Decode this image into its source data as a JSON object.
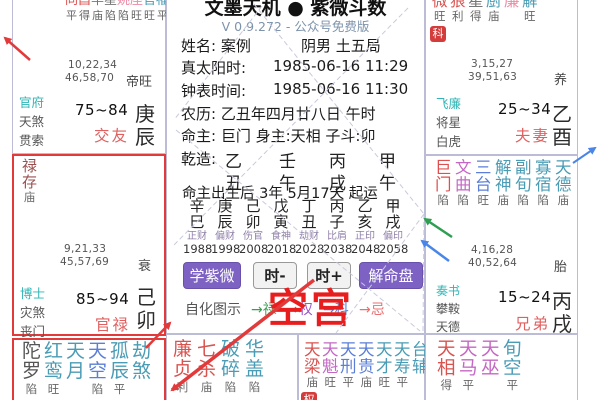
{
  "app": {
    "title": "文墨天机 ● 紫微斗数",
    "version": "V 0.9.272 - 公众号免费版"
  },
  "colors": {
    "red": "#e23a3a",
    "green": "#2e9e50",
    "blue": "#4a86e8"
  },
  "info": {
    "name_label": "姓名: 案例",
    "gender_bureau": "阴男 土五局",
    "solar_label": "真太阳时:",
    "solar_value": "1985-06-16  11:29",
    "clock_label": "钟表时间:",
    "clock_value": "1985-06-16  11:30",
    "lunar": "农历: 乙丑年四月廿八日 午时",
    "masters": "命主: 巨门 身主:天相 子斗:卯",
    "qianzao_label": "乾造:",
    "stems": [
      "乙",
      "壬",
      "丙",
      "甲"
    ],
    "branches": [
      "丑",
      "午",
      "戌",
      "午"
    ],
    "qiyun": "命主出生后 3年 5月17天 起运"
  },
  "dayun": {
    "columns": [
      {
        "stem": "辛",
        "branch": "巳",
        "god": "正财",
        "year": "1988"
      },
      {
        "stem": "庚",
        "branch": "辰",
        "god": "偏财",
        "year": "1998"
      },
      {
        "stem": "己",
        "branch": "卯",
        "god": "伤官",
        "year": "2008"
      },
      {
        "stem": "戊",
        "branch": "寅",
        "god": "食神",
        "year": "2018"
      },
      {
        "stem": "丁",
        "branch": "丑",
        "god": "劫财",
        "year": "2028"
      },
      {
        "stem": "丙",
        "branch": "子",
        "god": "比肩",
        "year": "2038"
      },
      {
        "stem": "乙",
        "branch": "亥",
        "god": "正印",
        "year": "2048"
      },
      {
        "stem": "甲",
        "branch": "戌",
        "god": "偏印",
        "year": "2058"
      }
    ]
  },
  "toolbar": {
    "learn": "学紫微",
    "minus": "时-",
    "plus": "时+",
    "explain": "解命盘"
  },
  "zihua": {
    "label": "自化图示",
    "lu": "→禄",
    "quan": "→权",
    "ke": "→科",
    "ji": "→忌",
    "lu_color": "#3aa050",
    "quan_color": "#9a55c8",
    "ke_color": "#5080d0",
    "ji_color": "#e87070"
  },
  "annotation": {
    "empty": "空宫",
    "color": "#e81e1e"
  },
  "palaces": {
    "jiaoyou": {
      "stars": [
        {
          "c": "同",
          "b": "平",
          "color": "#d9534f"
        },
        {
          "c": "昌",
          "b": "得",
          "color": "#d9534f"
        },
        {
          "c": "羊",
          "b": "庙",
          "color": "#777777"
        },
        {
          "c": "星",
          "b": "陷",
          "color": "#777777"
        },
        {
          "c": "姚",
          "b": "陷",
          "color": "#ed8aa5"
        },
        {
          "c": "座",
          "b": "旺",
          "color": "#ed8aa5"
        },
        {
          "c": "官",
          "b": "旺",
          "color": "#4a9cb5"
        },
        {
          "c": "福",
          "b": "平",
          "color": "#4a9cb5"
        }
      ],
      "nums1": "10,22,34",
      "nums2": "46,58,70",
      "stage": "帝旺",
      "gods": [
        {
          "t": "官府",
          "color": "#2fb5b5"
        },
        {
          "t": "天煞",
          "color": "#555555"
        },
        {
          "t": "贯索",
          "color": "#555555"
        }
      ],
      "age": "75~84",
      "name": "交友",
      "gz": "庚辰"
    },
    "guanlu": {
      "stars": [
        {
          "c": "禄存",
          "b": "庙",
          "color": "#9c4f4f"
        }
      ],
      "nums1": "9,21,33",
      "nums2": "45,57,69",
      "stage": "衰",
      "gods": [
        {
          "t": "博士",
          "color": "#2fb5b5"
        },
        {
          "t": "灾煞",
          "color": "#555555"
        },
        {
          "t": "丧门",
          "color": "#555555"
        }
      ],
      "age": "85~94",
      "name": "官禄",
      "gz": "己卯"
    },
    "fuqi": {
      "stars": [
        {
          "c": "微",
          "b": "旺",
          "color": "#d9534f"
        },
        {
          "c": "狼",
          "b": "利",
          "color": "#d9534f"
        },
        {
          "c": "星",
          "b": "得",
          "color": "#777777"
        },
        {
          "c": "厨",
          "b": "庙",
          "color": "#4a9cb5"
        },
        {
          "c": "廉",
          "b": "",
          "color": "#ed8aa5"
        },
        {
          "c": "解",
          "b": "旺",
          "color": "#4a9cb5"
        }
      ],
      "badge": "科",
      "nums1": "3,15,27",
      "nums2": "39,51,63",
      "stage": "养",
      "gods": [
        {
          "t": "飞廉",
          "color": "#2fb5b5"
        },
        {
          "t": "将星",
          "color": "#555555"
        },
        {
          "t": "白虎",
          "color": "#555555"
        }
      ],
      "age": "25~34",
      "name": "夫妻",
      "gz": "乙酉"
    },
    "xiongdi": {
      "stars": [
        {
          "c": "巨门",
          "b": "陷",
          "color": "#e04f4f"
        },
        {
          "c": "文曲",
          "b": "陷",
          "color": "#c568c5"
        },
        {
          "c": "三台",
          "b": "旺",
          "color": "#5b7fd6"
        },
        {
          "c": "解神",
          "b": "庙",
          "color": "#4a9cb5"
        },
        {
          "c": "副旬",
          "b": "陷",
          "color": "#4a9cb5"
        },
        {
          "c": "寡宿",
          "b": "陷",
          "color": "#4a9cb5"
        },
        {
          "c": "天德",
          "b": "庙",
          "color": "#4a9cb5"
        }
      ],
      "nums1": "4,16,28",
      "nums2": "40,52,64",
      "stage": "胎",
      "gods": [
        {
          "t": "奏书",
          "color": "#2fb5b5"
        },
        {
          "t": "攀鞍",
          "color": "#555555"
        },
        {
          "t": "天德",
          "color": "#555555"
        }
      ],
      "age": "15~24",
      "name": "兄弟",
      "gz": "丙戌"
    },
    "b1": {
      "stars": [
        {
          "c": "陀罗",
          "b": "陷",
          "color": "#555555"
        },
        {
          "c": "红鸾",
          "b": "旺",
          "color": "#4a9cb5"
        },
        {
          "c": "天月",
          "b": "",
          "color": "#4a9cb5"
        },
        {
          "c": "天空",
          "b": "陷",
          "color": "#5b7fd6"
        },
        {
          "c": "孤辰",
          "b": "平",
          "color": "#4a9cb5"
        },
        {
          "c": "劫煞",
          "b": "",
          "color": "#4a9cb5"
        }
      ]
    },
    "b2": {
      "stars": [
        {
          "c": "廉贞",
          "b": "利",
          "color": "#d9534f"
        },
        {
          "c": "七杀",
          "b": "庙",
          "color": "#d9534f"
        },
        {
          "c": "破碎",
          "b": "陷",
          "color": "#4a9cb5"
        },
        {
          "c": "华盖",
          "b": "陷",
          "color": "#4a9cb5"
        }
      ]
    },
    "b3": {
      "stars": [
        {
          "c": "天梁",
          "b": "庙",
          "color": "#d9534f"
        },
        {
          "c": "天魁",
          "b": "旺",
          "color": "#c568c5"
        },
        {
          "c": "天刑",
          "b": "平",
          "color": "#5b7fd6"
        },
        {
          "c": "天贵",
          "b": "庙",
          "color": "#5b7fd6"
        },
        {
          "c": "天才",
          "b": "旺",
          "color": "#4a9cb5"
        },
        {
          "c": "天寿",
          "b": "平",
          "color": "#4a9cb5"
        },
        {
          "c": "台辅",
          "b": "",
          "color": "#4a9cb5"
        }
      ],
      "badge": "权"
    },
    "b4": {
      "stars": [
        {
          "c": "天相",
          "b": "得",
          "color": "#d9534f"
        },
        {
          "c": "天马",
          "b": "平",
          "color": "#c568c5"
        },
        {
          "c": "天巫",
          "b": "",
          "color": "#c568c5"
        },
        {
          "c": "旬空",
          "b": "平",
          "color": "#4a9cb5"
        }
      ]
    }
  }
}
